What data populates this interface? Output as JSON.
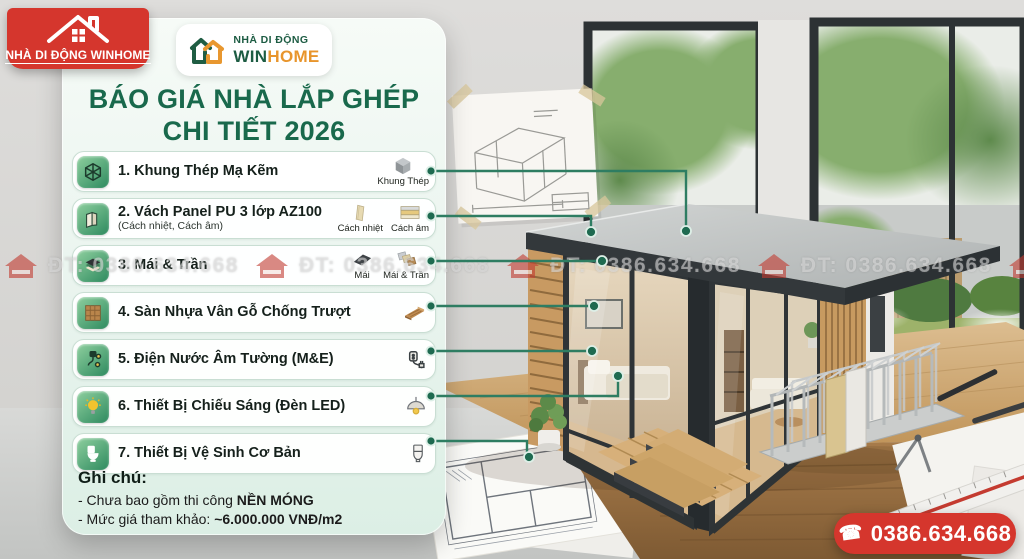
{
  "badge": {
    "label": "NHÀ DI ĐỘNG WINHOME",
    "icon": "red-house-icon"
  },
  "logo": {
    "line1": "NHÀ DI ĐỘNG",
    "win": "WIN",
    "home": "HOME",
    "icon": "winhome-double-house-icon"
  },
  "title": {
    "line1": "BÁO GIÁ NHÀ LẮP GHÉP",
    "line2": "CHI TIẾT 2026"
  },
  "list": {
    "items": [
      {
        "title": "1. Khung Thép Mạ Kẽm",
        "icon": "steel-frame-cube-icon",
        "tags": [
          {
            "label": "Khung Thép",
            "icon": "gray-cube-icon"
          }
        ]
      },
      {
        "title": "2. Vách Panel PU 3 lớp AZ100",
        "subtitle": "(Cách nhiệt, Cách âm)",
        "icon": "wall-panel-icon",
        "tags": [
          {
            "label": "Cách nhiệt",
            "icon": "insulation-panel-icon"
          },
          {
            "label": "Cách âm",
            "icon": "layered-acoustic-panel-icon"
          }
        ]
      },
      {
        "title": "3. Mái & Trần",
        "icon": "roof-layers-icon",
        "tags": [
          {
            "label": "Mái",
            "icon": "roof-sheet-icon"
          },
          {
            "label": "Mái & Trần",
            "icon": "roof-ceiling-panels-icon"
          }
        ]
      },
      {
        "title": "4. Sàn Nhựa Vân Gỗ Chống Trượt",
        "icon": "wood-floor-icon",
        "tags": [
          {
            "label": "",
            "icon": "wood-plank-icon"
          }
        ]
      },
      {
        "title": "5. Điện Nước Âm Tường (M&E)",
        "icon": "electric-plug-icon",
        "tags": [
          {
            "label": "",
            "icon": "socket-plug-icon"
          }
        ]
      },
      {
        "title": "6. Thiết Bị Chiếu Sáng (Đèn LED)",
        "icon": "light-bulb-icon",
        "tags": [
          {
            "label": "",
            "icon": "pendant-lamp-icon"
          }
        ]
      },
      {
        "title": "7. Thiết Bị Vệ Sinh Cơ Bản",
        "icon": "toilet-icon",
        "tags": [
          {
            "label": "",
            "icon": "toilet-outline-icon"
          }
        ]
      }
    ]
  },
  "notes": {
    "heading": "Ghi chú:",
    "line1_prefix": "- Chưa bao gồm thi công ",
    "line1_bold": "NỀN MÓNG",
    "line2_prefix": "- Mức giá tham khảo: ",
    "line2_bold": "~6.000.000 VNĐ/m2"
  },
  "watermark": {
    "text": "ĐT: 0386.634.668",
    "icon": "red-house-watermark-icon"
  },
  "phone": {
    "number": "0386.634.668",
    "icon_glyph": "☎"
  },
  "colors": {
    "brand_green": "#19694c",
    "brand_orange": "#e8952c",
    "badge_red": "#d5362d",
    "connector_green": "#2e7d62",
    "card_mint": "#e9f4ee"
  }
}
